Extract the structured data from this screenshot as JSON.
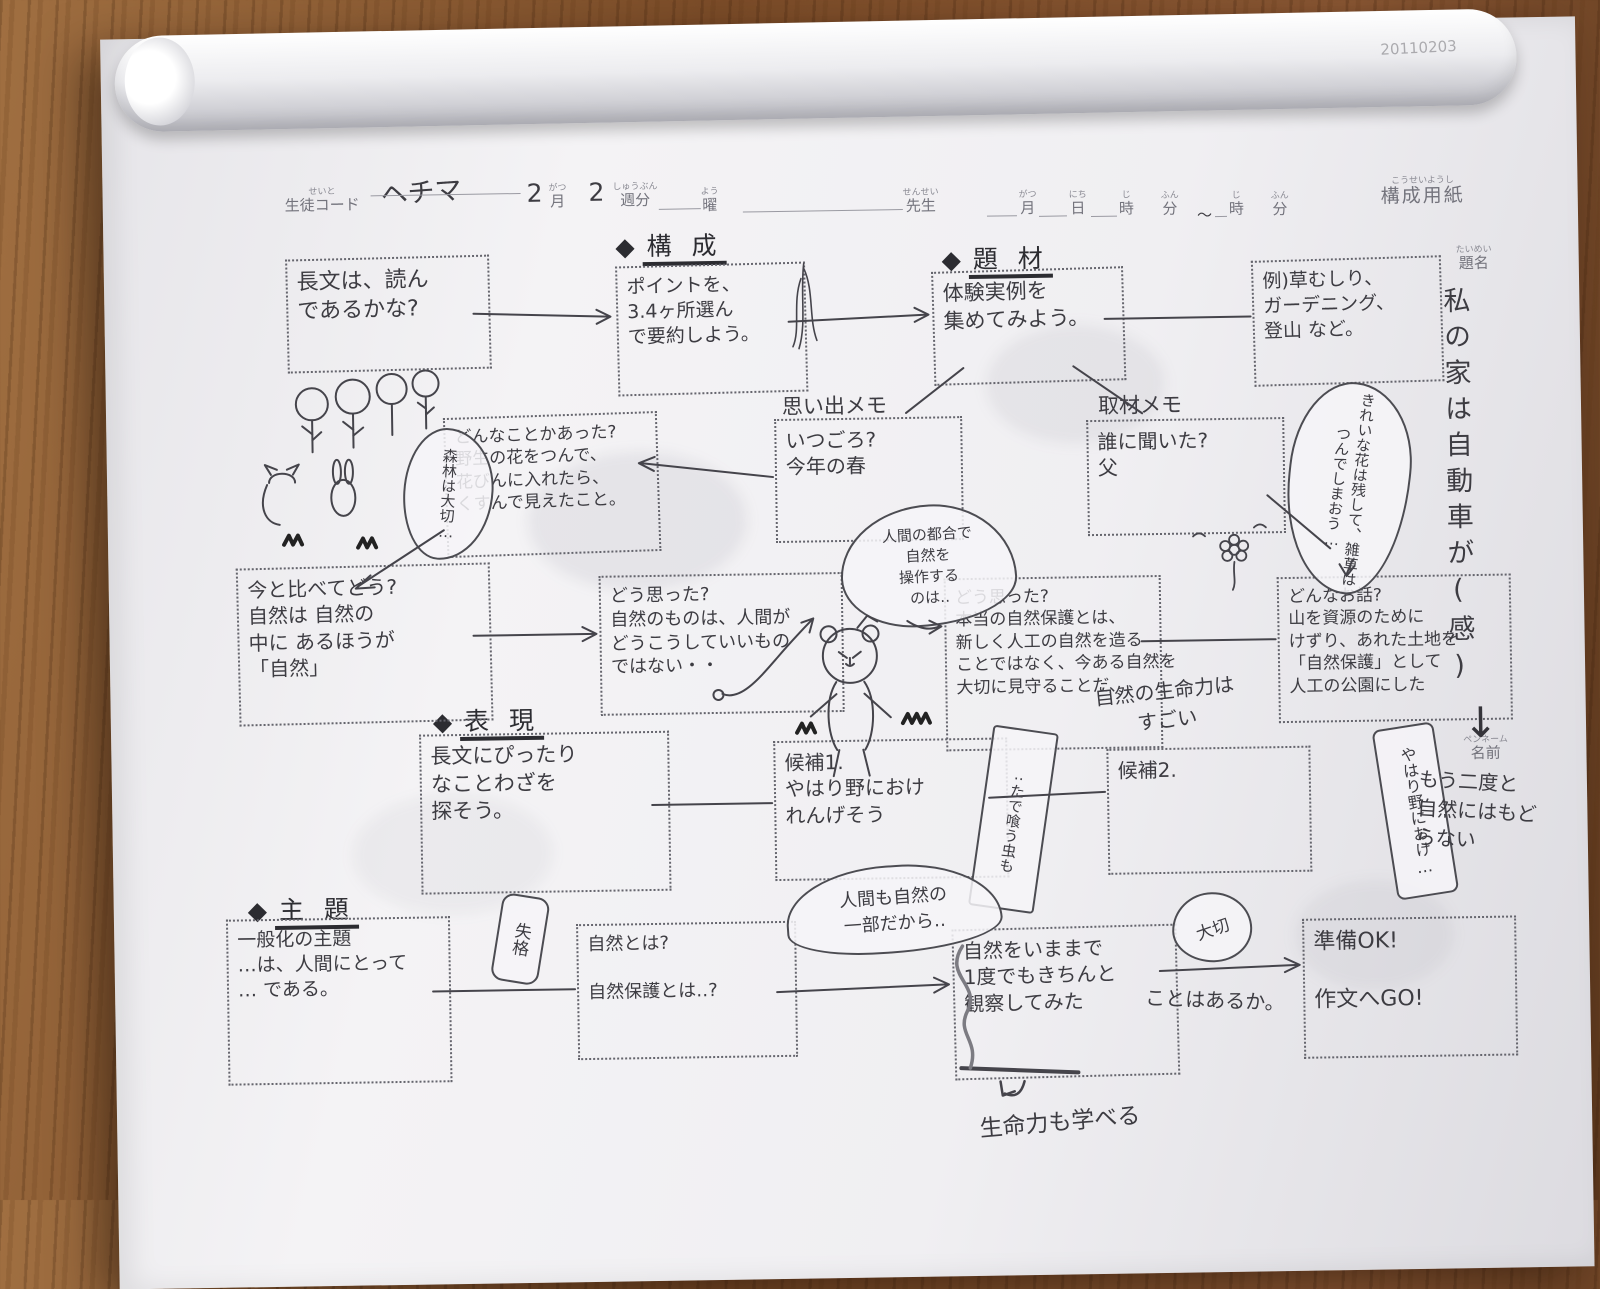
{
  "header": {
    "student_code": {
      "furigana": "せいと",
      "label": "生徒コード",
      "value": "ヘチマ"
    },
    "month": {
      "value": "2",
      "furigana": "がつ",
      "label": "月"
    },
    "week": {
      "value": "2",
      "furigana": "しゅうぶん",
      "label": "週分"
    },
    "day_of_week": {
      "furigana": "よう",
      "label": "曜"
    },
    "teacher": {
      "furigana": "せんせい",
      "label": "先生"
    },
    "date_line": {
      "month": {
        "furigana": "がつ",
        "label": "月"
      },
      "day": {
        "furigana": "にち",
        "label": "日"
      },
      "hour1": {
        "furigana": "じ",
        "label": "時"
      },
      "min1": {
        "furigana": "ふん",
        "label": "分"
      },
      "tilde": "～",
      "hour2": {
        "furigana": "じ",
        "label": "時"
      },
      "min2": {
        "furigana": "ふん",
        "label": "分"
      }
    },
    "sheet_name": {
      "furigana": "こうせいようし",
      "label": "構成用紙"
    },
    "corner_code": "20110203"
  },
  "title_block": {
    "furigana": "たいめい",
    "label": "題名",
    "value": "私の家は自動車が(感)"
  },
  "pen_name_block": {
    "furigana": "ペンネーム",
    "label": "名前"
  },
  "sections": {
    "kousei": {
      "bullet": "◆",
      "label": "構 成"
    },
    "daizai": {
      "bullet": "◆",
      "label": "題 材"
    },
    "hyougen": {
      "bullet": "◆",
      "label": "表 現"
    },
    "shudai": {
      "bullet": "◆",
      "label": "主 題"
    }
  },
  "boxes": {
    "choubun": "長文は、読ん\nであるかな?",
    "point": "ポイントを、\n3.4ヶ所選ん\nで要約しよう。",
    "taiken": "体験実例を\n集めてみよう。",
    "rei": "例)草むしり、\nガーデニング、\n登山 など。",
    "omoide": {
      "label": "思い出メモ",
      "text": "いつごろ?\n今年の春"
    },
    "shuzai": {
      "label": "取材メモ",
      "text": "誰に聞いた?\n父"
    },
    "donnakoto": "どんなことかあった?\n野生の花をつんで、\n花びんに入れたら、\nくすんで見えたこと。",
    "imakurabe": "今と比べてどう?\n自然は 自然の\n中に あるほうが\n「自然」",
    "doomotta1": "どう思った?\n自然のものは、人間が\nどうこうしていいもの\nではない・・",
    "doomotta2": "どう思った?\n本当の自然保護とは、\n新しく人工の自然を造る\nことではなく、今ある自然を\n大切に見守ることだ、",
    "donnaohanashi": "どんなお話?\n山を資源のために\nけずり、あれた土地を\n「自然保護」として\n人工の公園にした",
    "hyougenmain": "長文にぴったり\nなことわざを\n探そう。",
    "kouho1": "候補1.\nやはり野におけ\nれんげそう",
    "kouho2": "候補2.",
    "shudaimain": "一般化の主題\n…は、人間にとって\n… である。",
    "shizentowa": "自然とは?\n\n自然保護とは‥?",
    "kansatsu": "自然をいままで\n1度でもきちんと\n観察してみた",
    "kansatsu_overflow": "ことはあるか。",
    "junbi": "準備OK!\n\n作文へGO!"
  },
  "notes": {
    "shinrin_bubble": "森林は大切…",
    "kirei_bubble": "きれいな花は残して、雑草はつんでしまおう…",
    "kuma_bubble": "人間の都合で\n自然を\n操作する\nのは‥",
    "seimeiryoku": "自然の生命力は\nすごい",
    "yahari_strip": "やはり野におけ…",
    "mou_nido": "もう二度と\n自然にはもど\nらない",
    "tade_strip": "‥たで喰う虫も",
    "ichibu_bubble": "人間も自然の\n一部だから‥",
    "tag": "失格",
    "taisetsu_bubble": "大切",
    "seimei_manabu": "生命力も学べる",
    "arrow_down": "↓"
  }
}
